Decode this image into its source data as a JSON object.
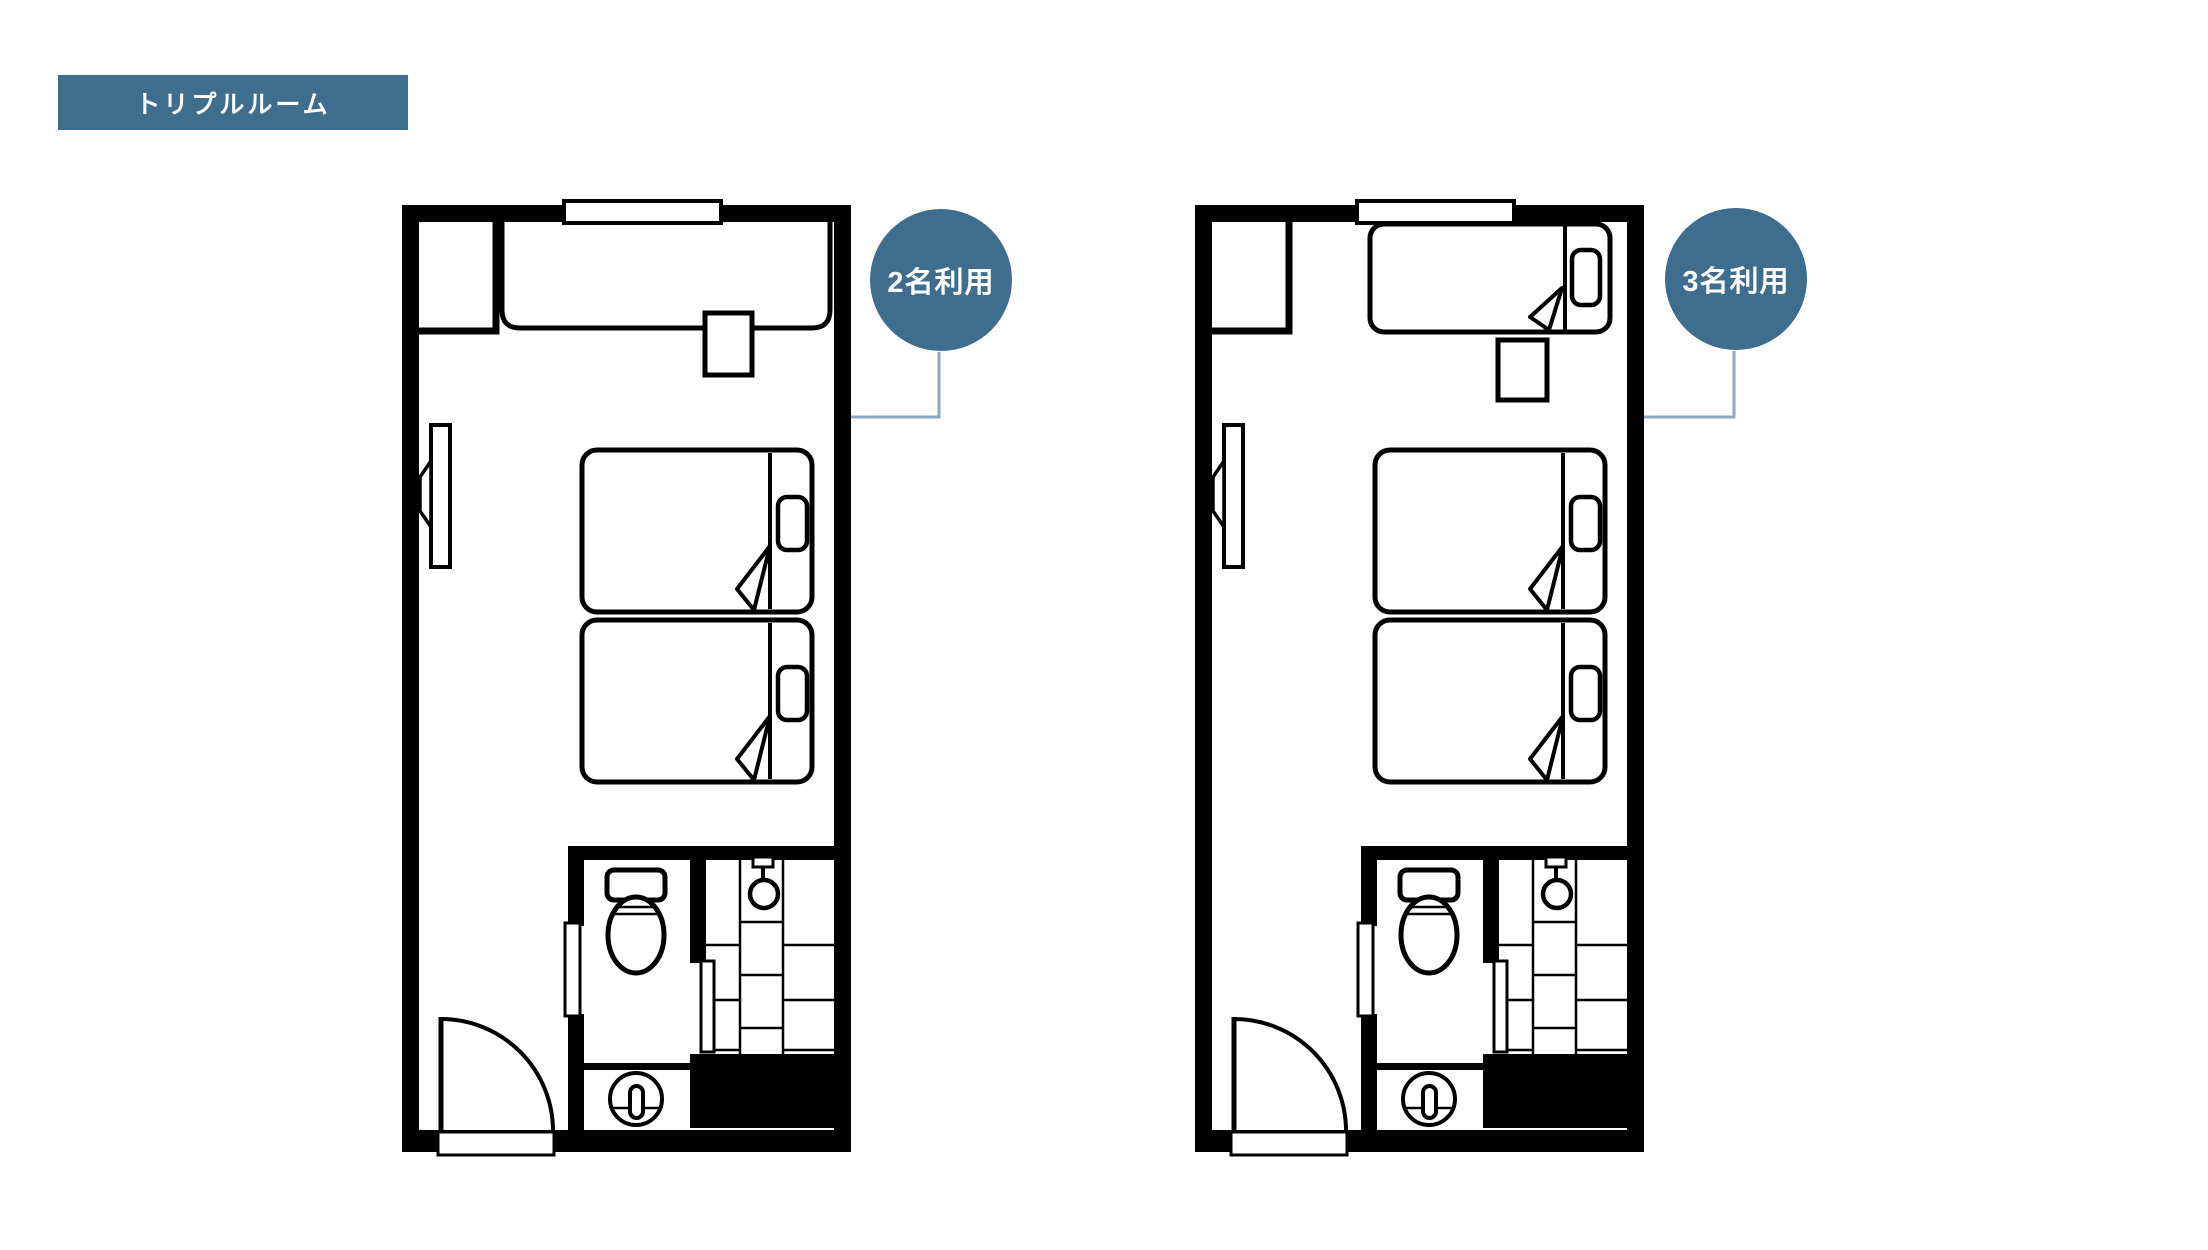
{
  "title_badge": {
    "label": "トリプルルーム"
  },
  "plans": [
    {
      "id": "plan-2-guests",
      "occupancy_label": "2名利用",
      "beds_shown": 2
    },
    {
      "id": "plan-3-guests",
      "occupancy_label": "3名利用",
      "beds_shown": 3
    }
  ],
  "colors": {
    "accent_blue": "#3E6D8E",
    "connector_line": "#8FA8BD",
    "plan_line": "#000000",
    "background": "#FFFFFF",
    "label_text": "#FFFFFF"
  }
}
